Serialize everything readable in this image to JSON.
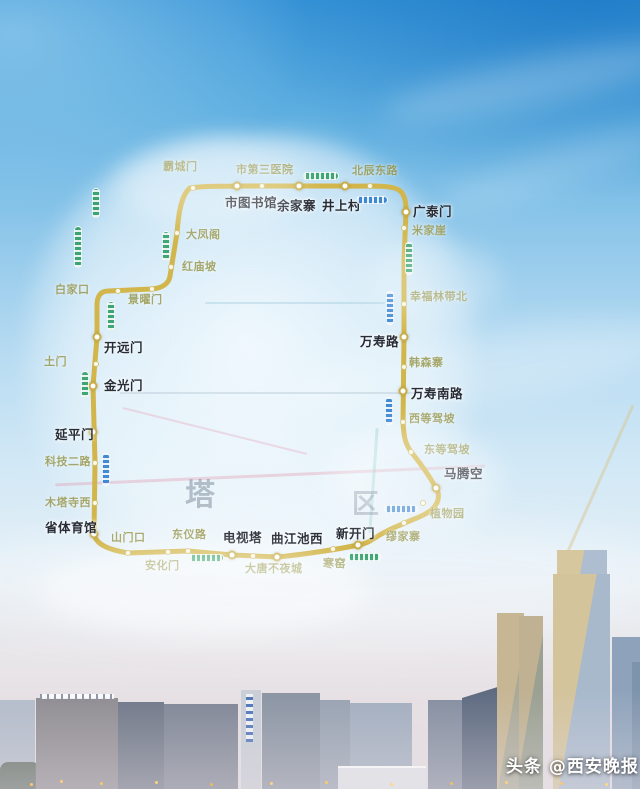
{
  "watermark": {
    "text": "头条 @西安晚报"
  },
  "map": {
    "type": "metro-loop-map",
    "line_color": "#d2b64b",
    "district_labels": [
      {
        "char": "塔",
        "x": 185,
        "y": 470,
        "size": 30
      },
      {
        "char": "区",
        "x": 352,
        "y": 482,
        "size": 27
      }
    ],
    "stations": [
      {
        "name": "霸城门",
        "style": "minor",
        "dot": [
          193,
          188
        ],
        "label": [
          163,
          158
        ]
      },
      {
        "name": "市第三医院",
        "style": "minor",
        "dot": [
          262,
          186
        ],
        "label": [
          236,
          161
        ]
      },
      {
        "name": "北辰东路",
        "style": "minor",
        "dot": [
          370,
          186
        ],
        "label": [
          352,
          162
        ]
      },
      {
        "name": "市图书馆",
        "style": "major",
        "dot": [
          237,
          186
        ],
        "label": [
          225,
          192
        ]
      },
      {
        "name": "余家寨",
        "style": "major",
        "dot": [
          299,
          186
        ],
        "label": [
          277,
          195
        ]
      },
      {
        "name": "井上村",
        "style": "major",
        "dot": [
          345,
          186
        ],
        "label": [
          322,
          195
        ]
      },
      {
        "name": "广泰门",
        "style": "major",
        "dot": [
          406,
          212
        ],
        "label": [
          413,
          201
        ]
      },
      {
        "name": "米家崖",
        "style": "minor",
        "dot": [
          404,
          228
        ],
        "label": [
          412,
          222
        ]
      },
      {
        "name": "幸福林带北",
        "style": "minor",
        "dot": [
          404,
          304
        ],
        "label": [
          410,
          288
        ]
      },
      {
        "name": "万寿路",
        "style": "major",
        "dot": [
          404,
          337
        ],
        "label": [
          360,
          331
        ]
      },
      {
        "name": "韩森寨",
        "style": "minor",
        "dot": [
          404,
          367
        ],
        "label": [
          409,
          354
        ]
      },
      {
        "name": "万寿南路",
        "style": "major",
        "dot": [
          403,
          391
        ],
        "label": [
          411,
          383
        ]
      },
      {
        "name": "西等驾坡",
        "style": "minor",
        "dot": [
          403,
          422
        ],
        "label": [
          409,
          410
        ]
      },
      {
        "name": "东等驾坡",
        "style": "minor",
        "dot": [
          411,
          452
        ],
        "label": [
          424,
          441
        ]
      },
      {
        "name": "马腾空",
        "style": "major",
        "dot": [
          436,
          488
        ],
        "label": [
          444,
          463
        ]
      },
      {
        "name": "植物园",
        "style": "minor",
        "dot": [
          423,
          503
        ],
        "label": [
          430,
          505
        ]
      },
      {
        "name": "缪家寨",
        "style": "minor",
        "dot": [
          404,
          523
        ],
        "label": [
          386,
          528
        ]
      },
      {
        "name": "新开门",
        "style": "major",
        "dot": [
          358,
          545
        ],
        "label": [
          336,
          523
        ]
      },
      {
        "name": "寒窑",
        "style": "minor",
        "dot": [
          333,
          549
        ],
        "label": [
          323,
          555
        ]
      },
      {
        "name": "曲江池西",
        "style": "major",
        "dot": [
          277,
          557
        ],
        "label": [
          271,
          528
        ]
      },
      {
        "name": "大唐不夜城",
        "style": "minor",
        "dot": [
          253,
          556
        ],
        "label": [
          245,
          560
        ]
      },
      {
        "name": "电视塔",
        "style": "major",
        "dot": [
          232,
          555
        ],
        "label": [
          223,
          527
        ]
      },
      {
        "name": "安化门",
        "style": "minor",
        "dot": [
          168,
          552
        ],
        "label": [
          145,
          557
        ]
      },
      {
        "name": "东仪路",
        "style": "minor",
        "dot": [
          188,
          551
        ],
        "label": [
          172,
          526
        ]
      },
      {
        "name": "山门口",
        "style": "minor",
        "dot": [
          128,
          553
        ],
        "label": [
          111,
          529
        ]
      },
      {
        "name": "省体育馆",
        "style": "major",
        "dot": [
          94,
          534
        ],
        "label": [
          45,
          517
        ]
      },
      {
        "name": "木塔寺西",
        "style": "minor",
        "dot": [
          95,
          503
        ],
        "label": [
          45,
          494
        ]
      },
      {
        "name": "科技二路",
        "style": "minor",
        "dot": [
          95,
          463
        ],
        "label": [
          45,
          453
        ]
      },
      {
        "name": "延平门",
        "style": "major",
        "dot": [
          93,
          432
        ],
        "label": [
          55,
          424
        ]
      },
      {
        "name": "金光门",
        "style": "major",
        "dot": [
          93,
          386
        ],
        "label": [
          104,
          375
        ]
      },
      {
        "name": "土门",
        "style": "minor",
        "dot": [
          96,
          364
        ],
        "label": [
          44,
          353
        ]
      },
      {
        "name": "开远门",
        "style": "major",
        "dot": [
          97,
          337
        ],
        "label": [
          104,
          337
        ]
      },
      {
        "name": "景曜门",
        "style": "minor",
        "dot": [
          152,
          289
        ],
        "label": [
          128,
          291
        ]
      },
      {
        "name": "白家口",
        "style": "minor",
        "dot": [
          118,
          291
        ],
        "label": [
          55,
          281
        ]
      },
      {
        "name": "红庙坡",
        "style": "minor",
        "dot": [
          171,
          267
        ],
        "label": [
          182,
          258
        ]
      },
      {
        "name": "大凤阁",
        "style": "minor",
        "dot": [
          177,
          233
        ],
        "label": [
          186,
          226
        ]
      }
    ],
    "trains": [
      {
        "color": "green",
        "orient": "h",
        "x": 303,
        "y": 172,
        "w": 36,
        "h": 8
      },
      {
        "color": "blue",
        "orient": "h",
        "x": 356,
        "y": 196,
        "w": 32,
        "h": 8
      },
      {
        "color": "green",
        "orient": "v",
        "x": 92,
        "y": 188,
        "w": 8,
        "h": 30
      },
      {
        "color": "green",
        "orient": "v",
        "x": 74,
        "y": 226,
        "w": 8,
        "h": 42
      },
      {
        "color": "green",
        "orient": "v",
        "x": 162,
        "y": 231,
        "w": 8,
        "h": 30
      },
      {
        "color": "green",
        "orient": "v",
        "x": 107,
        "y": 301,
        "w": 8,
        "h": 30
      },
      {
        "color": "green",
        "orient": "v",
        "x": 81,
        "y": 371,
        "w": 8,
        "h": 27
      },
      {
        "color": "blue",
        "orient": "v",
        "x": 102,
        "y": 453,
        "w": 8,
        "h": 33
      },
      {
        "color": "green",
        "orient": "v",
        "x": 405,
        "y": 242,
        "w": 8,
        "h": 33
      },
      {
        "color": "blue",
        "orient": "v",
        "x": 386,
        "y": 291,
        "w": 8,
        "h": 34
      },
      {
        "color": "blue",
        "orient": "v",
        "x": 385,
        "y": 397,
        "w": 8,
        "h": 28
      },
      {
        "color": "green",
        "orient": "h",
        "x": 189,
        "y": 554,
        "w": 35,
        "h": 8
      },
      {
        "color": "green",
        "orient": "h",
        "x": 347,
        "y": 553,
        "w": 34,
        "h": 8
      },
      {
        "color": "blue",
        "orient": "h",
        "x": 384,
        "y": 505,
        "w": 34,
        "h": 8
      }
    ]
  }
}
